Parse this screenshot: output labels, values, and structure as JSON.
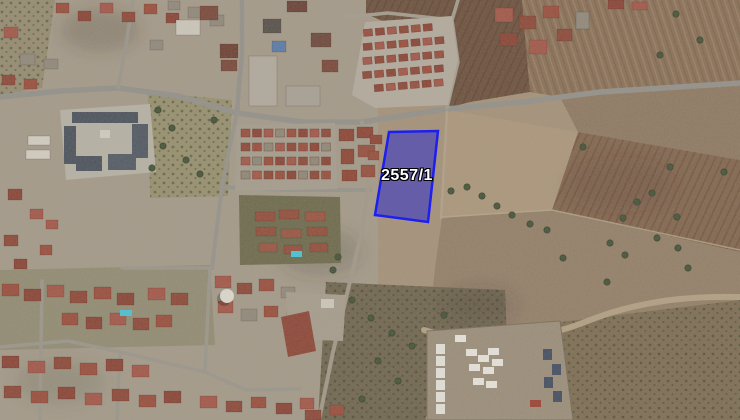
{
  "map": {
    "kind": "satellite-aerial-view",
    "colors": {
      "parcel_fill": "#2b2bd0",
      "parcel_fill_opacity": 0.52,
      "parcel_border": "#1d1ff0",
      "label_text": "#ffffff",
      "label_outline": "#000000"
    }
  },
  "parcel": {
    "label": "2557/1",
    "polygon_points": [
      [
        389,
        132
      ],
      [
        438,
        131
      ],
      [
        428,
        222
      ],
      [
        375,
        215
      ]
    ],
    "label_position": {
      "x": 381,
      "y": 167
    }
  }
}
